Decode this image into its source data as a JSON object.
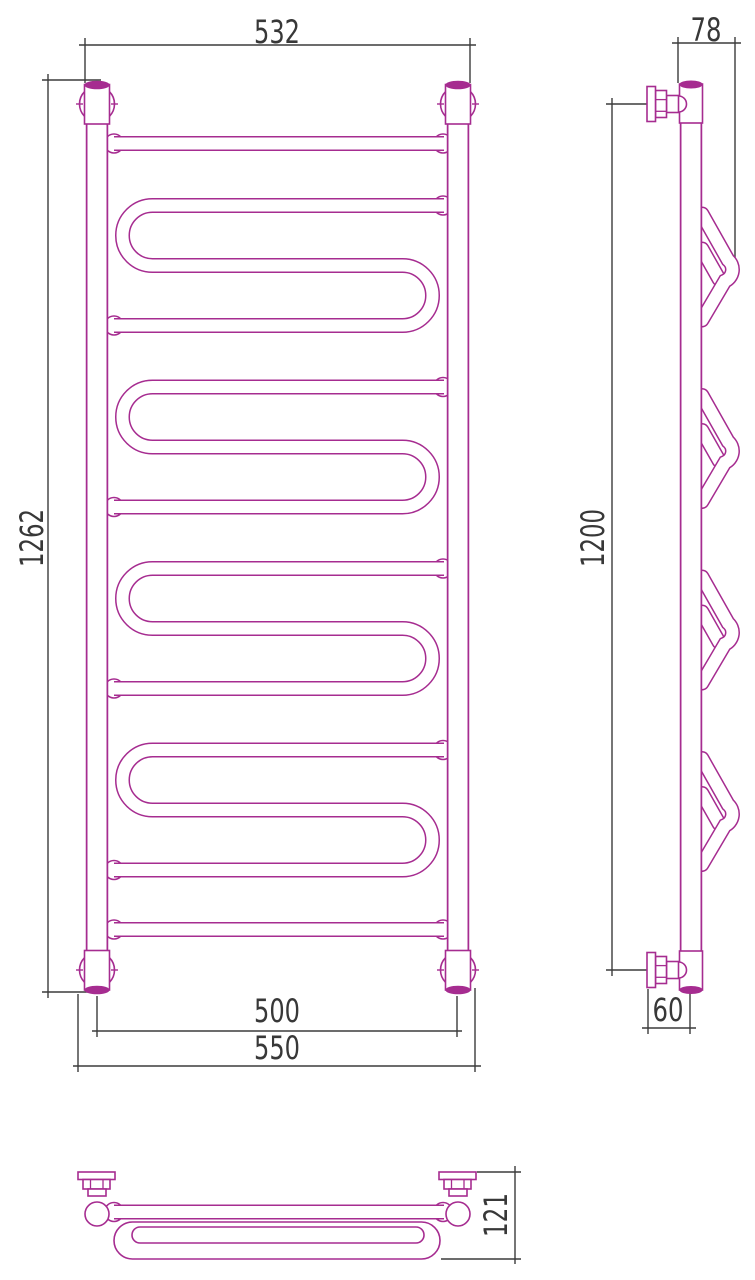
{
  "drawing": {
    "kind": "technical dimension drawing",
    "subject": "ladder heated towel rail with serpentine coils",
    "views": {
      "front": "front view",
      "side": "side view",
      "bottom": "top/plan view"
    },
    "coil_count": 4,
    "rung_count": 2
  },
  "dims": {
    "front_width": "532",
    "front_height": "1262",
    "front_inner_width": "500",
    "front_outer_width": "550",
    "side_depth": "78",
    "side_height": "1200",
    "side_wall_offset": "60",
    "plan_depth": "121"
  },
  "colors": {
    "outline": "#a62c90",
    "dimension": "#3c3c3c",
    "text": "#383838",
    "background": "#ffffff"
  }
}
